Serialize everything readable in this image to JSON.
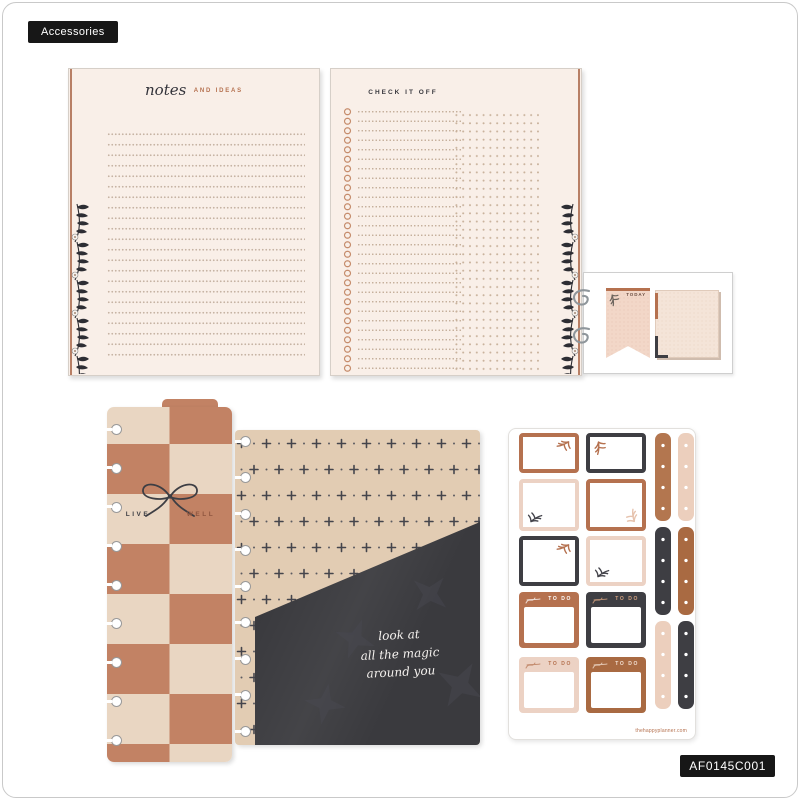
{
  "page": {
    "label": "Accessories",
    "sku": "AF0145C001"
  },
  "notes_page": {
    "title_script": "notes",
    "title_caps": "AND IDEAS"
  },
  "checklist_page": {
    "title": "CHECK IT OFF"
  },
  "sticky_notes": {
    "banner_label": "TODAY"
  },
  "bookmark": {
    "left_word": "LIVE",
    "right_word": "WELL"
  },
  "folder": {
    "quote_lines": [
      "look at",
      "all the magic",
      "around you"
    ]
  },
  "sticker_sheet": {
    "todo_label": "TO DO",
    "website": "thehappyplanner.com"
  },
  "colors": {
    "rust": "#b5714f",
    "rust_deep": "#a96a42",
    "blush": "#eccfbd",
    "blush_box": "#ecd2c4",
    "charcoal": "#3e3e43",
    "cream_page": "#f9efe8",
    "checker_cream": "#e9d6c2",
    "checker_rust": "#c28264",
    "folder_tan": "#e2ccb3",
    "pocket": "#3a3a3e",
    "badge_bg": "#171717"
  }
}
